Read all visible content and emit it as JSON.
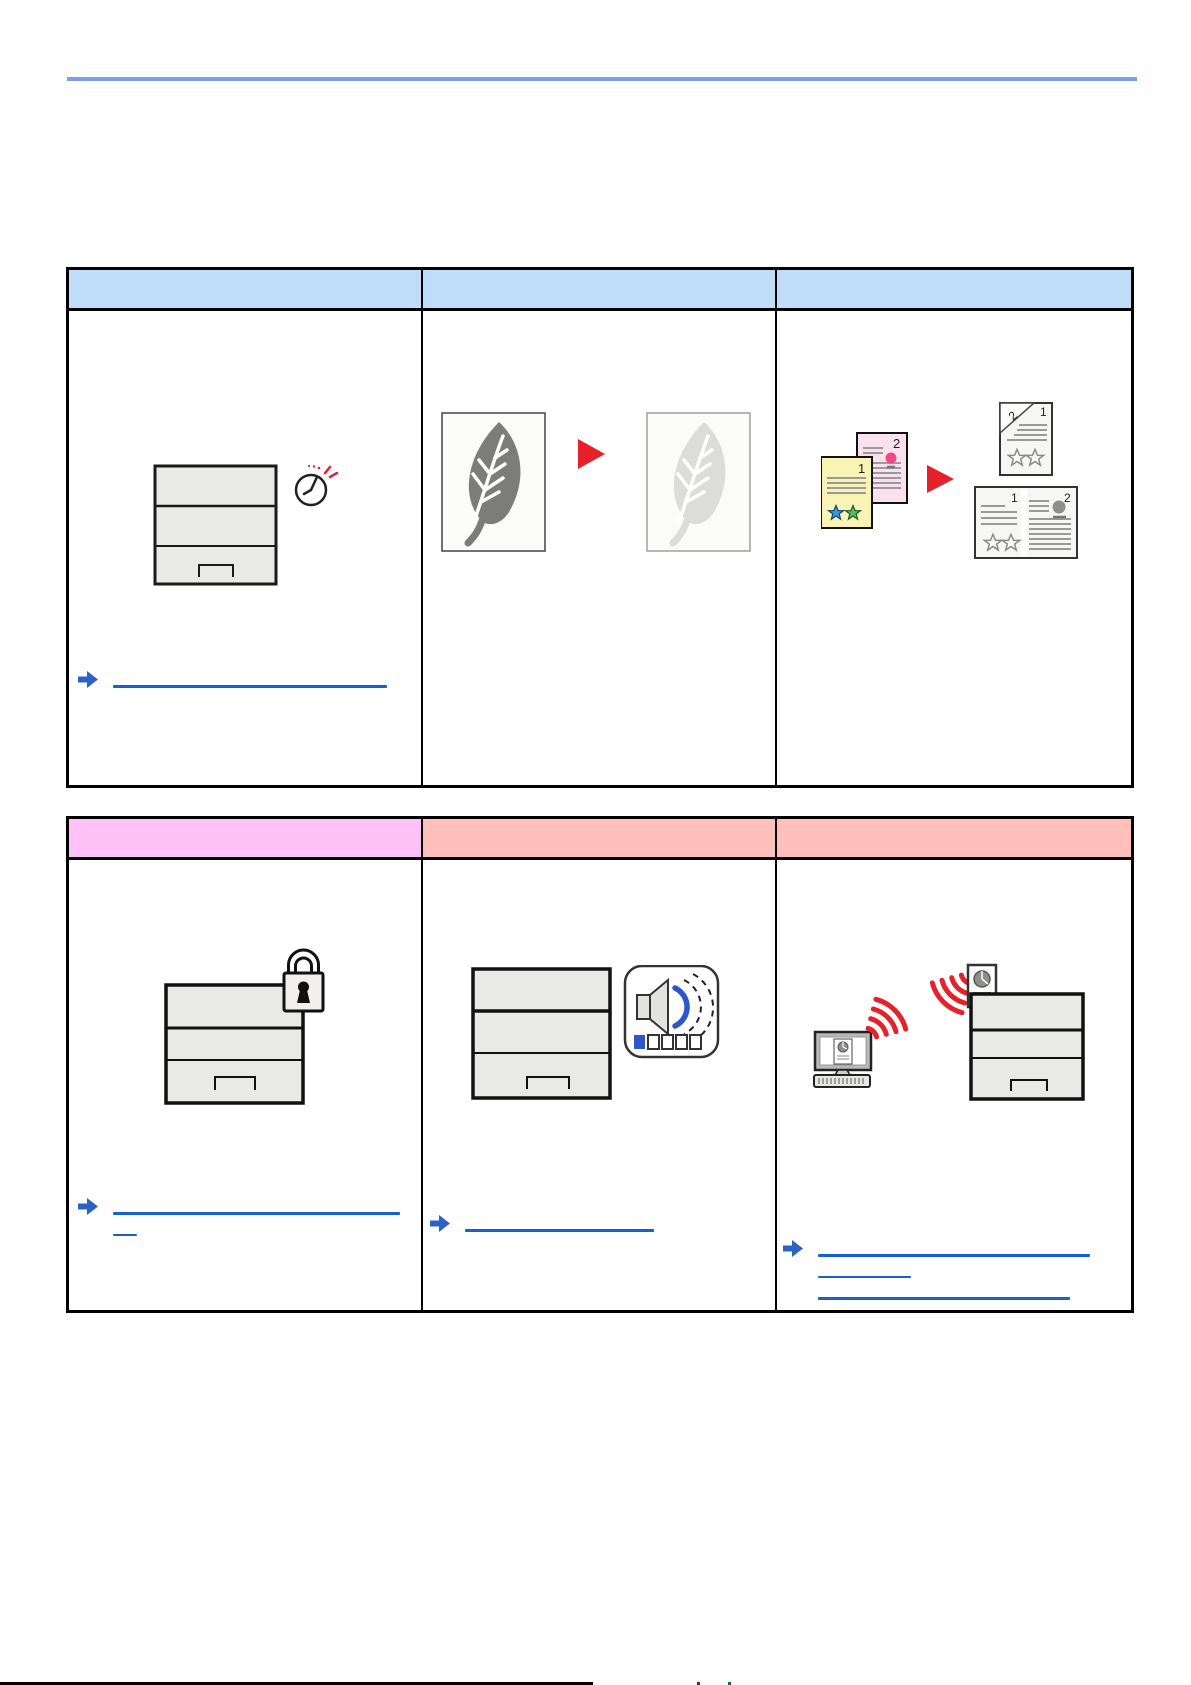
{
  "page": {
    "top_rule_color": "#7d9de8",
    "footer": {
      "rule_color": "#000000",
      "fragment_colors": [
        "#5a2040",
        "#006a6a"
      ]
    }
  },
  "link_style": {
    "arrow_color": "#2b63c4",
    "underline_color": "#175fd4"
  },
  "accent": {
    "red": "#e6212b",
    "speaker_blue": "#2b57c8"
  },
  "quiet_mode": {
    "volume_segments": 5,
    "volume_active_segments": 1
  },
  "table1": {
    "header_cells": [
      {
        "label": "",
        "bg": "#bfddf8"
      },
      {
        "label": "",
        "bg": "#bfddf8"
      },
      {
        "label": "",
        "bg": "#bfddf8"
      }
    ],
    "cells": [
      {
        "icon": "printer-sleep-timer-icon",
        "link": {
          "text": ""
        }
      },
      {
        "icon": "toner-save-leaf-icon"
      },
      {
        "icon": "duplex-combine-pages-icon",
        "page_numbers": {
          "original_a": "1",
          "original_b": "2",
          "duplex_back": "2",
          "duplex_front": "1",
          "twoup_left": "1",
          "twoup_right": "2"
        }
      }
    ]
  },
  "table2": {
    "header_cells": [
      {
        "label": "",
        "bg": "#ffc2f6"
      },
      {
        "label": "",
        "bg": "#ffc0bc"
      },
      {
        "label": "",
        "bg": "#ffc0bc"
      }
    ],
    "cells": [
      {
        "icon": "security-lock-printer-icon",
        "link": {
          "text": ""
        }
      },
      {
        "icon": "quiet-mode-volume-icon",
        "link": {
          "text": ""
        }
      },
      {
        "icon": "wireless-print-icon",
        "link": {
          "text": ""
        }
      }
    ]
  }
}
